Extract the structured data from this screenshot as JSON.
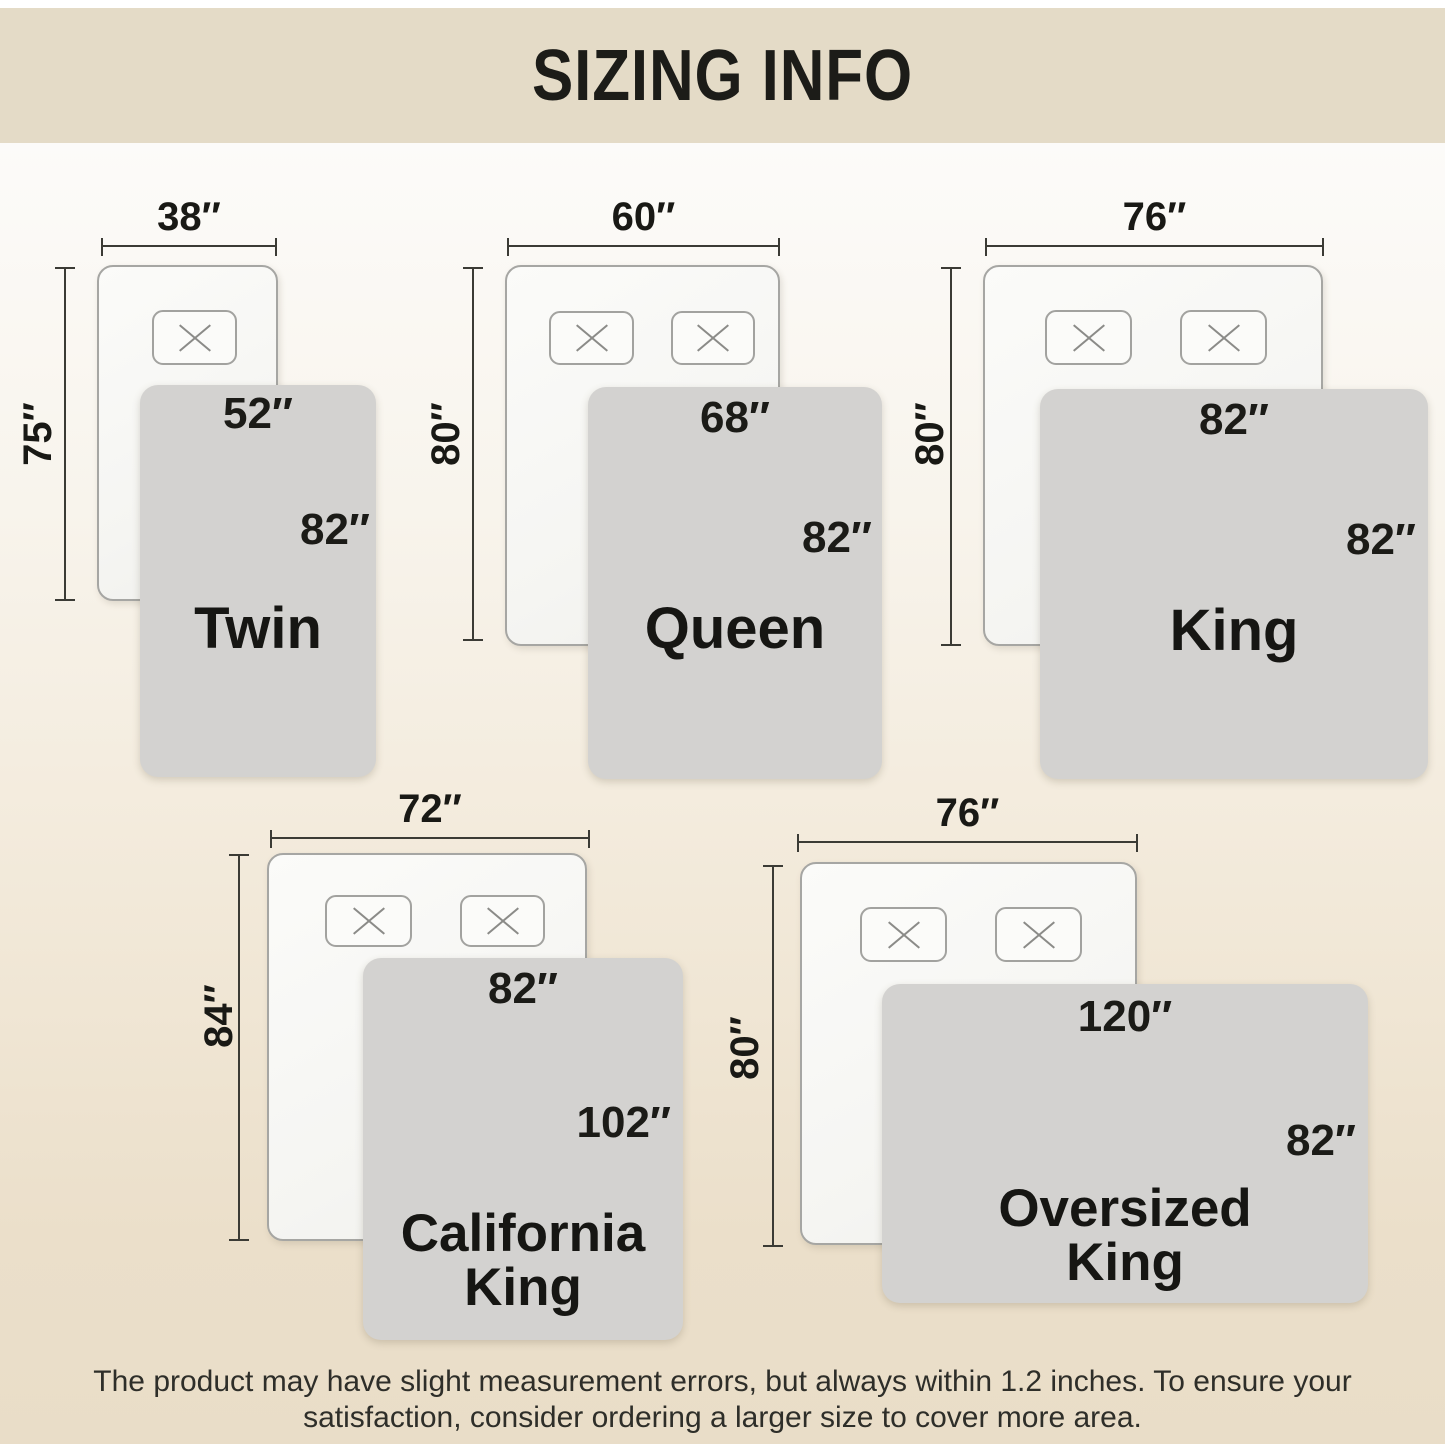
{
  "title": "SIZING INFO",
  "sizes": [
    {
      "name": "Twin",
      "bed_width": "38″",
      "bed_length": "75″",
      "blanket_width": "52″",
      "blanket_length": "82″",
      "pillow_count": 1
    },
    {
      "name": "Queen",
      "bed_width": "60″",
      "bed_length": "80″",
      "blanket_width": "68″",
      "blanket_length": "82″",
      "pillow_count": 2
    },
    {
      "name": "King",
      "bed_width": "76″",
      "bed_length": "80″",
      "blanket_width": "82″",
      "blanket_length": "82″",
      "pillow_count": 2
    },
    {
      "name": "California King",
      "name_line1": "California",
      "name_line2": "King",
      "bed_width": "72″",
      "bed_length": "84″",
      "blanket_width": "82″",
      "blanket_length": "102″",
      "pillow_count": 2
    },
    {
      "name": "Oversized King",
      "name_line1": "Oversized",
      "name_line2": "King",
      "bed_width": "76″",
      "bed_length": "80″",
      "blanket_width": "120″",
      "blanket_length": "82″",
      "pillow_count": 2
    }
  ],
  "footer": {
    "line1": "The product may have slight measurement errors, but always within 1.2 inches. To ensure your",
    "line2": "satisfaction, consider ordering a larger size to cover more area."
  },
  "colors": {
    "header_bg": "#e4dbc7",
    "background_bottom": "#e9ddc8",
    "blanket_gray": "#d3d2d0",
    "bed_white": "#f8f8f5",
    "line_dark": "#3b3b35",
    "text_dark": "#1b1b17"
  }
}
